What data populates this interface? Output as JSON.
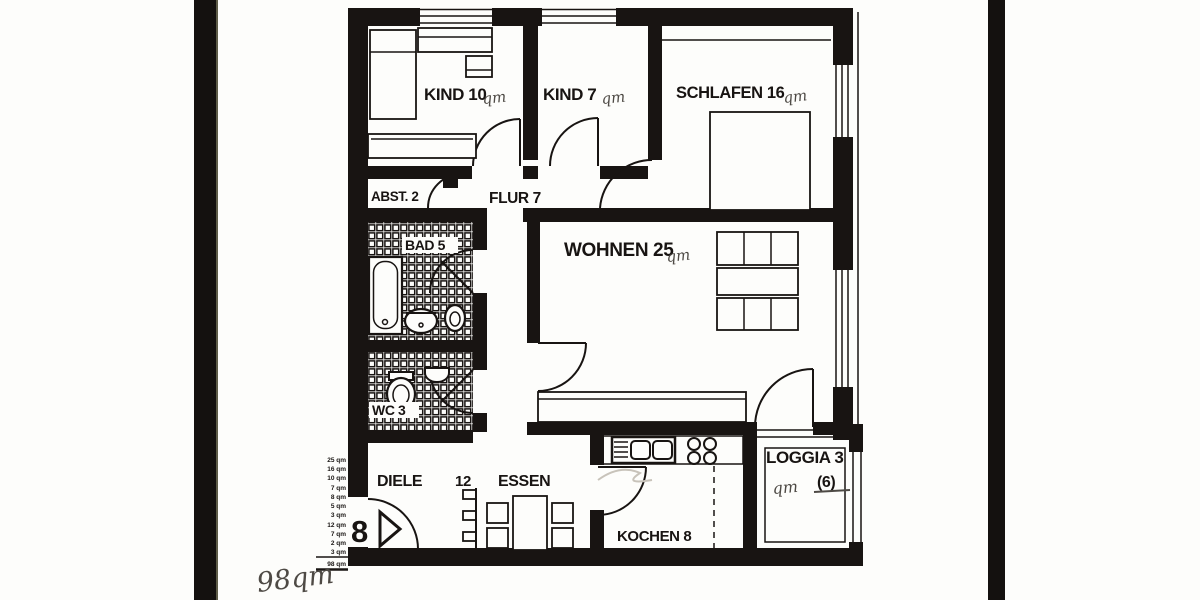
{
  "document": {
    "type": "apartment-floor-plan-scan"
  },
  "rooms": {
    "kind1": "KIND 10",
    "kind2": "KIND 7",
    "schlafen": "SCHLAFEN 16",
    "abst": "ABST. 2",
    "flur": "FLUR 7",
    "bad": "BAD 5",
    "wc": "WC 3",
    "wohnen": "WOHNEN 25",
    "diele": "DIELE",
    "diele_number": "12",
    "essen": "ESSEN",
    "kochen": "KOCHEN 8",
    "loggia": "LOGGIA 3"
  },
  "annotations": {
    "qm": "qm",
    "loggia_note": "(6)",
    "entrance_number": "8",
    "total_handwritten": "98qm"
  },
  "area_table": {
    "items": [
      "25 qm",
      "16 qm",
      "10 qm",
      "7 qm",
      "8 qm",
      "5 qm",
      "3 qm",
      "12 qm",
      "7 qm",
      "2 qm",
      "3 qm"
    ],
    "total": "98 qm"
  },
  "colors": {
    "ink": "#181412",
    "paper": "#fdfdfb",
    "pencil": "#4e4a45"
  }
}
